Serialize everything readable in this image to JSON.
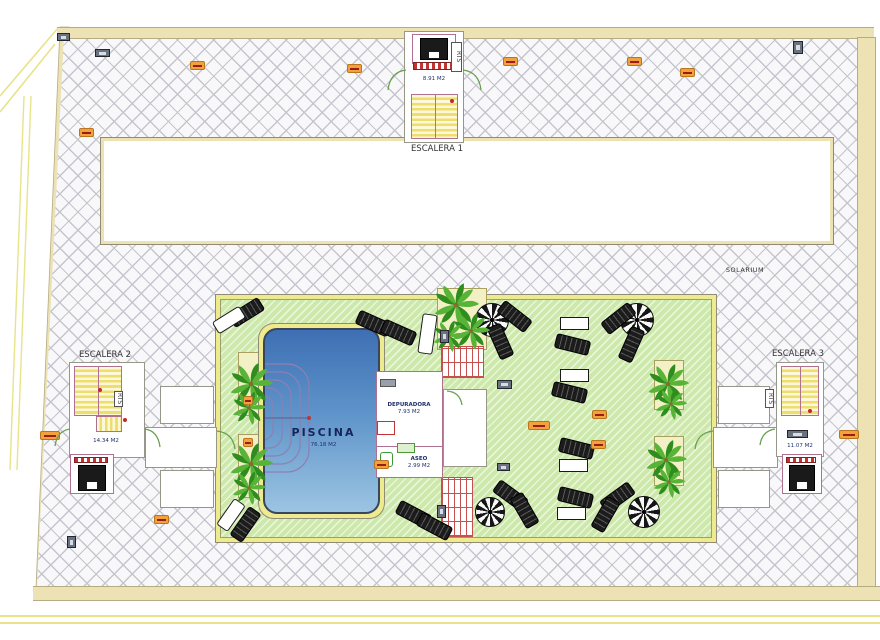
{
  "labels": {
    "escalera1": "ESCALERA 1",
    "escalera1_area": "8.91 M2",
    "escalera2": "ESCALERA 2",
    "escalera2_area": "14.34 M2",
    "escalera3": "ESCALERA 3",
    "escalera3_area": "11.07 M2",
    "rts": "RTS",
    "solarium": "SOLARIUM",
    "piscina": "PISCINA",
    "piscina_area": "76.18 M2",
    "depuradora": "DEPURADORA",
    "depuradora_area": "7.93 M2",
    "aseo": "ASEO",
    "aseo_area": "2.99 M2"
  },
  "colors": {
    "hatch_line": "#c5c5cd",
    "site_band": "#ece2b4",
    "green": "#cde8ab",
    "green_border": "#eeea8e",
    "pool_top": "#3e6fb4",
    "pool_bottom": "#9cc4e2",
    "wall_pink": "#b07090",
    "step_yellow": "#eedd6f",
    "accent_orange": "#f2a23c",
    "accent_red": "#c23434",
    "palm_dark": "#2f8d1e",
    "palm_light": "#57b437"
  },
  "furniture": {
    "parasols": [
      {
        "x": 492,
        "y": 320,
        "r": 17
      },
      {
        "x": 637,
        "y": 320,
        "r": 17
      },
      {
        "x": 490,
        "y": 512,
        "r": 15
      },
      {
        "x": 644,
        "y": 512,
        "r": 16
      }
    ],
    "loungers_black": [
      {
        "x": 245,
        "y": 311,
        "rot": -32
      },
      {
        "x": 372,
        "y": 322,
        "rot": 24
      },
      {
        "x": 397,
        "y": 331,
        "rot": 24
      },
      {
        "x": 513,
        "y": 315,
        "rot": 38
      },
      {
        "x": 499,
        "y": 340,
        "rot": 66
      },
      {
        "x": 617,
        "y": 317,
        "rot": -38
      },
      {
        "x": 630,
        "y": 343,
        "rot": -66
      },
      {
        "x": 571,
        "y": 343,
        "rot": 14
      },
      {
        "x": 568,
        "y": 391,
        "rot": 14
      },
      {
        "x": 575,
        "y": 447,
        "rot": 14
      },
      {
        "x": 574,
        "y": 496,
        "rot": 14
      },
      {
        "x": 509,
        "y": 494,
        "rot": 36
      },
      {
        "x": 523,
        "y": 509,
        "rot": 60
      },
      {
        "x": 616,
        "y": 496,
        "rot": -36
      },
      {
        "x": 604,
        "y": 513,
        "rot": -60
      },
      {
        "x": 412,
        "y": 513,
        "rot": 28
      },
      {
        "x": 433,
        "y": 525,
        "rot": 28
      },
      {
        "x": 244,
        "y": 523,
        "rot": -55
      }
    ],
    "loungers_white": [
      {
        "x": 228,
        "y": 319,
        "rot": -32,
        "w": 30,
        "h": 12
      },
      {
        "x": 230,
        "y": 514,
        "rot": -55,
        "w": 30,
        "h": 12
      },
      {
        "x": 426,
        "y": 333,
        "rot": 8,
        "w": 13,
        "h": 38
      }
    ],
    "tables_white": [
      {
        "x": 573,
        "y": 322,
        "w": 27,
        "h": 11
      },
      {
        "x": 573,
        "y": 374,
        "w": 27,
        "h": 11
      },
      {
        "x": 572,
        "y": 464,
        "w": 27,
        "h": 11
      },
      {
        "x": 570,
        "y": 512,
        "w": 27,
        "h": 11
      }
    ],
    "palms": [
      {
        "x": 251,
        "y": 384,
        "s": 46
      },
      {
        "x": 249,
        "y": 408,
        "s": 36
      },
      {
        "x": 251,
        "y": 464,
        "s": 46
      },
      {
        "x": 249,
        "y": 488,
        "s": 36
      },
      {
        "x": 456,
        "y": 305,
        "s": 48
      },
      {
        "x": 471,
        "y": 331,
        "s": 40
      },
      {
        "x": 449,
        "y": 336,
        "s": 34
      },
      {
        "x": 668,
        "y": 384,
        "s": 44
      },
      {
        "x": 671,
        "y": 404,
        "s": 34
      },
      {
        "x": 666,
        "y": 460,
        "s": 44
      },
      {
        "x": 669,
        "y": 482,
        "s": 34
      }
    ],
    "orange_tags": [
      {
        "x": 190,
        "y": 61
      },
      {
        "x": 347,
        "y": 64
      },
      {
        "x": 503,
        "y": 57
      },
      {
        "x": 627,
        "y": 57
      },
      {
        "x": 680,
        "y": 68
      },
      {
        "x": 79,
        "y": 128
      },
      {
        "x": 40,
        "y": 431,
        "w": 18
      },
      {
        "x": 154,
        "y": 515
      },
      {
        "x": 839,
        "y": 430,
        "w": 18
      },
      {
        "x": 528,
        "y": 421,
        "w": 20
      },
      {
        "x": 592,
        "y": 410
      },
      {
        "x": 591,
        "y": 440
      },
      {
        "x": 374,
        "y": 460
      },
      {
        "x": 243,
        "y": 396,
        "w": 8
      },
      {
        "x": 243,
        "y": 438,
        "w": 8
      }
    ],
    "dark_badges": [
      {
        "x": 57,
        "y": 33,
        "w": 13,
        "h": 8
      },
      {
        "x": 95,
        "y": 49,
        "w": 15,
        "h": 8
      },
      {
        "x": 793,
        "y": 41,
        "w": 10,
        "h": 13
      },
      {
        "x": 67,
        "y": 536,
        "w": 9,
        "h": 12
      },
      {
        "x": 440,
        "y": 330,
        "w": 9,
        "h": 13
      },
      {
        "x": 497,
        "y": 380,
        "w": 15,
        "h": 9
      },
      {
        "x": 437,
        "y": 505,
        "w": 9,
        "h": 13
      },
      {
        "x": 497,
        "y": 463,
        "w": 13,
        "h": 8
      },
      {
        "x": 787,
        "y": 430,
        "w": 21,
        "h": 8
      }
    ],
    "red_dots": [
      {
        "x": 452,
        "y": 101
      },
      {
        "x": 100,
        "y": 390
      },
      {
        "x": 125,
        "y": 420
      },
      {
        "x": 810,
        "y": 411
      }
    ]
  }
}
